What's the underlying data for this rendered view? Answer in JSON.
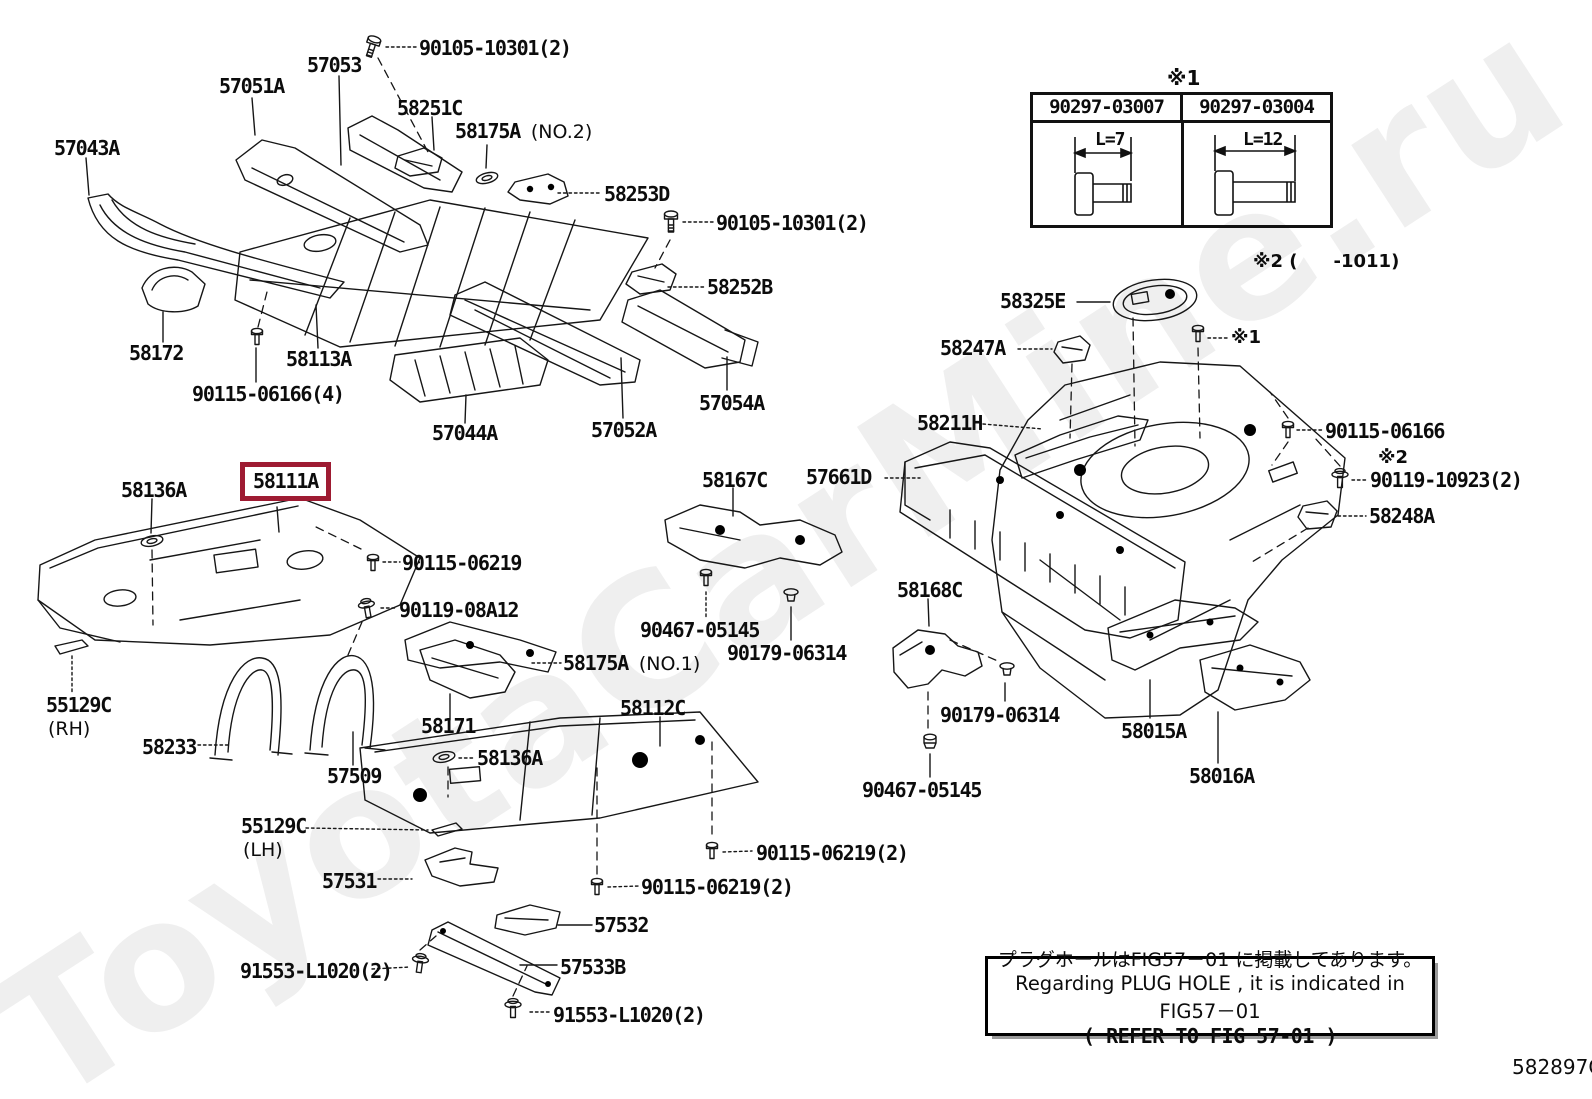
{
  "watermark": "ToyotaCarMine.ru",
  "figure_code": "582897G",
  "highlight_color": "#9e1b32",
  "note_box": {
    "line_jp": "プラグホールはFIG57－01 に掲載してあります。",
    "line_en": "Regarding PLUG HOLE , it is indicated in FIG57－01",
    "line_ref": "( REFER TO FIG 57-01 )"
  },
  "spec_table": {
    "marker": "※1",
    "columns": [
      {
        "part_number": "90297-03007",
        "length": "L=7"
      },
      {
        "part_number": "90297-03004",
        "length": "L=12"
      }
    ]
  },
  "labels": [
    {
      "text": "90105-10301(2)"
    },
    {
      "text": "57053"
    },
    {
      "text": "57051A"
    },
    {
      "text": "58251C"
    },
    {
      "text": "58175A",
      "suffix": "(NO.2)"
    },
    {
      "text": "57043A"
    },
    {
      "text": "58253D"
    },
    {
      "text": "90105-10301(2)"
    },
    {
      "text": "58252B"
    },
    {
      "text": "58172"
    },
    {
      "text": "58113A"
    },
    {
      "text": "90115-06166(4)"
    },
    {
      "text": "57044A"
    },
    {
      "text": "57052A"
    },
    {
      "text": "57054A"
    },
    {
      "text": "58136A"
    },
    {
      "text": "58111A"
    },
    {
      "text": "90115-06219"
    },
    {
      "text": "90119-08A12"
    },
    {
      "text": "58167C"
    },
    {
      "text": "57661D"
    },
    {
      "text": "58325E"
    },
    {
      "text": "58247A"
    },
    {
      "text": "58211H"
    },
    {
      "text": "90115-06166"
    },
    {
      "text": "※2"
    },
    {
      "text": "90119-10923(2)"
    },
    {
      "text": "58248A"
    },
    {
      "text": "90467-05145"
    },
    {
      "text": "90179-06314"
    },
    {
      "text": "58168C"
    },
    {
      "text": "90179-06314"
    },
    {
      "text": "55129C",
      "suffix": "(RH)"
    },
    {
      "text": "58233"
    },
    {
      "text": "57509"
    },
    {
      "text": "58171"
    },
    {
      "text": "58136A"
    },
    {
      "text": "58175A",
      "suffix": "(NO.1)"
    },
    {
      "text": "58112C"
    },
    {
      "text": "58015A"
    },
    {
      "text": "58016A"
    },
    {
      "text": "90467-05145"
    },
    {
      "text": "55129C",
      "suffix": "(LH)"
    },
    {
      "text": "57531"
    },
    {
      "text": "90115-06219(2)"
    },
    {
      "text": "90115-06219(2)"
    },
    {
      "text": "57532"
    },
    {
      "text": "57533B"
    },
    {
      "text": "91553-L1020(2)"
    },
    {
      "text": "91553-L1020(2)"
    },
    {
      "text": "※1"
    },
    {
      "text": "※2 (　　-1011)"
    }
  ]
}
